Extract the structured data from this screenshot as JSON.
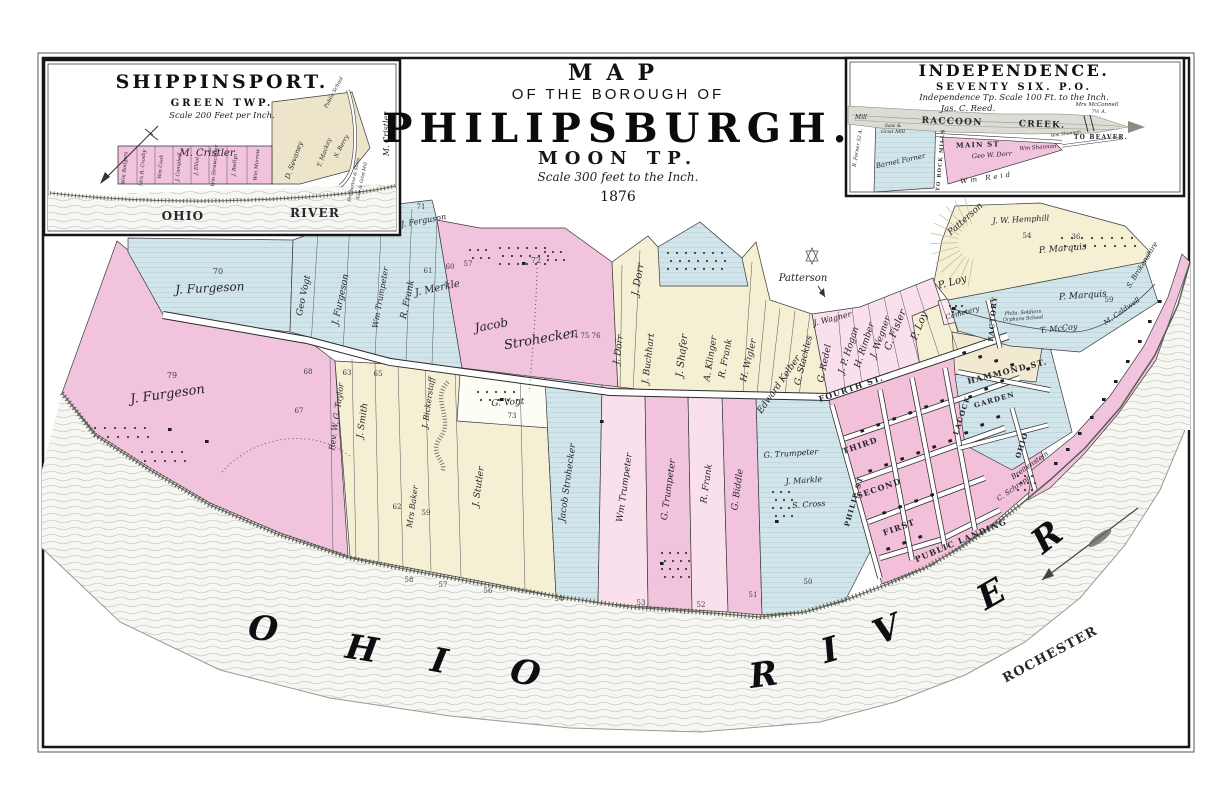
{
  "sheet": {
    "title_small": "MAP",
    "title_sub": "OF THE BOROUGH OF",
    "title_main": "PHILIPSBURGH.",
    "township": "MOON TP.",
    "scale_note": "Scale 300 feet to the Inch.",
    "year": "1876"
  },
  "inset_shippinsport": {
    "title": "SHIPPINSPORT.",
    "subtitle": "GREEN TWP.",
    "scale_note": "Scale 200 Feet per Inch.",
    "labels": [
      {
        "t": "M. Cristler",
        "x": 207,
        "y": 156,
        "s": 10
      },
      {
        "t": "Wm Rodgers",
        "x": 126,
        "y": 168,
        "r": -85,
        "s": 5
      },
      {
        "t": "Mrs R. Crosby",
        "x": 144,
        "y": 168,
        "r": -85,
        "s": 5
      },
      {
        "t": "Wm Cook",
        "x": 162,
        "y": 167,
        "r": -85,
        "s": 5
      },
      {
        "t": "J. Campbell",
        "x": 180,
        "y": 167,
        "r": -85,
        "s": 5
      },
      {
        "t": "J. Elliot",
        "x": 198,
        "y": 166,
        "r": -85,
        "s": 5
      },
      {
        "t": "Wm Strawcutter",
        "x": 216,
        "y": 166,
        "r": -85,
        "s": 5
      },
      {
        "t": "J. Bedlyn",
        "x": 236,
        "y": 165,
        "r": -85,
        "s": 5
      },
      {
        "t": "Wm Morrow",
        "x": 258,
        "y": 165,
        "r": -85,
        "s": 5
      },
      {
        "t": "D. Sevaney",
        "x": 296,
        "y": 161,
        "r": -70,
        "s": 7
      },
      {
        "t": "T. Mackey",
        "x": 326,
        "y": 153,
        "r": -70,
        "s": 6
      },
      {
        "t": "S. Berry",
        "x": 343,
        "y": 147,
        "r": -62,
        "s": 6
      },
      {
        "t": "Public School",
        "x": 335,
        "y": 93,
        "r": -62,
        "s": 5
      },
      {
        "t": "M. Cristler",
        "x": 389,
        "y": 134,
        "r": -90,
        "s": 8
      },
      {
        "t": "Brotherton & Stiles",
        "x": 355,
        "y": 180,
        "r": -78,
        "s": 4.5
      },
      {
        "t": "Saw & Grist Mill",
        "x": 363,
        "y": 181,
        "r": -78,
        "s": 4.5
      },
      {
        "t": "OHIO",
        "x": 183,
        "y": 220,
        "s": 12,
        "ls": 14,
        "c": "st"
      },
      {
        "t": "RIVER",
        "x": 315,
        "y": 217,
        "s": 12,
        "ls": 10,
        "c": "st"
      }
    ]
  },
  "inset_independence": {
    "title": "INDEPENDENCE.",
    "subtitle": "SEVENTY SIX. P.O.",
    "scale_note": "Independence Tp.  Scale 100 Ft. to the Inch.",
    "surveyor": "Jas. C. Reed.",
    "labels": [
      {
        "t": "RACCOON",
        "x": 952,
        "y": 124,
        "r": 2,
        "s": 9,
        "ls": 8,
        "c": "st"
      },
      {
        "t": "CREEK.",
        "x": 1042,
        "y": 127,
        "r": 2,
        "s": 9,
        "ls": 6,
        "c": "st"
      },
      {
        "t": "MAIN   ST",
        "x": 978,
        "y": 147,
        "r": -2,
        "s": 7,
        "ls": 4,
        "c": "st"
      },
      {
        "t": "Mill",
        "x": 861,
        "y": 119,
        "s": 6
      },
      {
        "t": "Saw &",
        "x": 893,
        "y": 127,
        "s": 5
      },
      {
        "t": "Grist Mill",
        "x": 893,
        "y": 133,
        "s": 5
      },
      {
        "t": "Barnet Forner",
        "x": 901,
        "y": 163,
        "r": -12,
        "s": 7
      },
      {
        "t": "Geo W. Dorr",
        "x": 992,
        "y": 157,
        "r": -4,
        "s": 6.5
      },
      {
        "t": "Wm Shannon",
        "x": 1038,
        "y": 149,
        "r": -4,
        "s": 5.5
      },
      {
        "t": "Wm  Reid",
        "x": 987,
        "y": 180,
        "r": -8,
        "s": 7,
        "ls": 3
      },
      {
        "t": "Mrs McConnell",
        "x": 1097,
        "y": 106,
        "s": 5.5
      },
      {
        "t": "7½ A.",
        "x": 1099,
        "y": 113,
        "s": 5
      },
      {
        "t": "TO BEAVER.",
        "x": 1101,
        "y": 139,
        "s": 6,
        "c": "st"
      },
      {
        "t": "Wm Shannon",
        "x": 1066,
        "y": 135,
        "r": -8,
        "s": 4.5
      },
      {
        "t": "TO ROCK MILLS",
        "x": 942,
        "y": 160,
        "r": -85,
        "s": 5,
        "c": "st"
      },
      {
        "t": "B. Forner 52 A.",
        "x": 859,
        "y": 148,
        "r": -80,
        "s": 5
      }
    ]
  },
  "main_map": {
    "labels": [
      {
        "t": "J. Furgeson",
        "x": 210,
        "y": 292,
        "r": -3,
        "s": 12
      },
      {
        "t": "70",
        "x": 218,
        "y": 274,
        "s": 8,
        "c": "num"
      },
      {
        "t": "J. Ferguson",
        "x": 424,
        "y": 223,
        "r": -10,
        "s": 8
      },
      {
        "t": "71",
        "x": 421,
        "y": 209,
        "s": 7,
        "c": "num"
      },
      {
        "t": "J. Furgeson",
        "x": 168,
        "y": 398,
        "r": -8,
        "s": 13
      },
      {
        "t": "79",
        "x": 172,
        "y": 378,
        "s": 8,
        "c": "num"
      },
      {
        "t": "Geo Vogt",
        "x": 306,
        "y": 296,
        "r": -78,
        "s": 9
      },
      {
        "t": "J. Furgeson",
        "x": 343,
        "y": 300,
        "r": -78,
        "s": 9
      },
      {
        "t": "Wm Trumpeter",
        "x": 383,
        "y": 298,
        "r": -80,
        "s": 8
      },
      {
        "t": "R. Frank",
        "x": 410,
        "y": 300,
        "r": -78,
        "s": 9
      },
      {
        "t": "J. Merkle",
        "x": 438,
        "y": 291,
        "r": -12,
        "s": 10
      },
      {
        "t": "61",
        "x": 428,
        "y": 273,
        "s": 7,
        "c": "num"
      },
      {
        "t": "60",
        "x": 450,
        "y": 269,
        "s": 7,
        "c": "num"
      },
      {
        "t": "57",
        "x": 468,
        "y": 266,
        "s": 7,
        "c": "num"
      },
      {
        "t": "Jacob",
        "x": 492,
        "y": 329,
        "r": -10,
        "s": 12
      },
      {
        "t": "Strohecker",
        "x": 541,
        "y": 343,
        "r": -10,
        "s": 13
      },
      {
        "t": "72",
        "x": 536,
        "y": 263,
        "s": 8,
        "c": "num"
      },
      {
        "t": "74 75 76",
        "x": 585,
        "y": 338,
        "s": 7,
        "c": "num"
      },
      {
        "t": "J. Dorr",
        "x": 641,
        "y": 280,
        "r": -80,
        "s": 10
      },
      {
        "t": "J. Dorr",
        "x": 621,
        "y": 350,
        "r": -82,
        "s": 9
      },
      {
        "t": "J. Buchhart",
        "x": 651,
        "y": 359,
        "r": -83,
        "s": 9
      },
      {
        "t": "J. Shafer",
        "x": 685,
        "y": 356,
        "r": -83,
        "s": 10
      },
      {
        "t": "A. Klinger",
        "x": 713,
        "y": 359,
        "r": -81,
        "s": 9
      },
      {
        "t": "R. Frank",
        "x": 728,
        "y": 359,
        "r": -79,
        "s": 9
      },
      {
        "t": "H. Wigler",
        "x": 751,
        "y": 361,
        "r": -76,
        "s": 9
      },
      {
        "t": "Edward Kelber",
        "x": 781,
        "y": 386,
        "r": -55,
        "s": 9
      },
      {
        "t": "G. Stackles",
        "x": 806,
        "y": 361,
        "r": -76,
        "s": 9
      },
      {
        "t": "G. Redel",
        "x": 827,
        "y": 364,
        "r": -78,
        "s": 9
      },
      {
        "t": "J. Wagner",
        "x": 833,
        "y": 321,
        "r": -14,
        "s": 8
      },
      {
        "t": "J. P. Hogan",
        "x": 851,
        "y": 351,
        "r": -72,
        "s": 9
      },
      {
        "t": "H. Rimber",
        "x": 867,
        "y": 346,
        "r": -72,
        "s": 9
      },
      {
        "t": "J. Wegner",
        "x": 883,
        "y": 338,
        "r": -70,
        "s": 9
      },
      {
        "t": "C. Fisler",
        "x": 898,
        "y": 331,
        "r": -68,
        "s": 10
      },
      {
        "t": "P. Loy",
        "x": 922,
        "y": 327,
        "r": -68,
        "s": 10
      },
      {
        "t": "P. Loy",
        "x": 953,
        "y": 285,
        "r": -15,
        "s": 10
      },
      {
        "t": "Cemetery",
        "x": 963,
        "y": 315,
        "r": -15,
        "s": 7
      },
      {
        "t": "Patterson",
        "x": 803,
        "y": 281,
        "s": 10
      },
      {
        "t": "Patterson",
        "x": 967,
        "y": 221,
        "r": -42,
        "s": 9
      },
      {
        "t": "J. W. Hemphill",
        "x": 1021,
        "y": 222,
        "r": -3,
        "s": 8
      },
      {
        "t": "54",
        "x": 1027,
        "y": 238,
        "s": 7,
        "c": "num"
      },
      {
        "t": "P. Marquis",
        "x": 1063,
        "y": 251,
        "r": -5,
        "s": 9
      },
      {
        "t": "36",
        "x": 1076,
        "y": 239,
        "s": 7,
        "c": "num"
      },
      {
        "t": "P. Marquis",
        "x": 1083,
        "y": 298,
        "r": -4,
        "s": 9
      },
      {
        "t": "59",
        "x": 1109,
        "y": 302,
        "s": 7,
        "c": "num"
      },
      {
        "t": "T. McCoy",
        "x": 1059,
        "y": 331,
        "r": -6,
        "s": 8
      },
      {
        "t": "S. Brokenshire",
        "x": 1144,
        "y": 266,
        "r": -58,
        "s": 7
      },
      {
        "t": "M. Caldwell",
        "x": 1123,
        "y": 313,
        "r": -35,
        "s": 7
      },
      {
        "t": "Phila. Soldiers",
        "x": 1023,
        "y": 314,
        "r": -4,
        "s": 5
      },
      {
        "t": "Orphans School",
        "x": 1023,
        "y": 320,
        "r": -4,
        "s": 5
      },
      {
        "t": "Rev. W. G. Taylor",
        "x": 339,
        "y": 417,
        "r": -82,
        "s": 8
      },
      {
        "t": "J. Smith",
        "x": 365,
        "y": 421,
        "r": -82,
        "s": 9
      },
      {
        "t": "J. Bickerstaff",
        "x": 431,
        "y": 403,
        "r": -82,
        "s": 8
      },
      {
        "t": "G. Vogt",
        "x": 508,
        "y": 405,
        "r": -4,
        "s": 9
      },
      {
        "t": "73",
        "x": 512,
        "y": 418,
        "s": 7,
        "c": "num"
      },
      {
        "t": "Mrs Baker",
        "x": 415,
        "y": 507,
        "r": -82,
        "s": 8
      },
      {
        "t": "J. Stutler",
        "x": 481,
        "y": 487,
        "r": -82,
        "s": 9
      },
      {
        "t": "Jacob Strohecker",
        "x": 570,
        "y": 483,
        "r": -82,
        "s": 9
      },
      {
        "t": "Wm Trumpeter",
        "x": 627,
        "y": 488,
        "r": -82,
        "s": 9
      },
      {
        "t": "G. Trumpeter",
        "x": 671,
        "y": 490,
        "r": -82,
        "s": 9
      },
      {
        "t": "R. Frank",
        "x": 709,
        "y": 484,
        "r": -82,
        "s": 9
      },
      {
        "t": "G. Biddle",
        "x": 740,
        "y": 490,
        "r": -82,
        "s": 9
      },
      {
        "t": "G. Trumpeter",
        "x": 791,
        "y": 456,
        "r": -4,
        "s": 8
      },
      {
        "t": "J. Markle",
        "x": 804,
        "y": 483,
        "r": -4,
        "s": 8
      },
      {
        "t": "S. Cross",
        "x": 809,
        "y": 507,
        "r": -4,
        "s": 8
      },
      {
        "t": "68",
        "x": 308,
        "y": 374,
        "s": 7,
        "c": "num"
      },
      {
        "t": "67",
        "x": 299,
        "y": 413,
        "s": 7,
        "c": "num"
      },
      {
        "t": "63",
        "x": 347,
        "y": 375,
        "s": 7,
        "c": "num"
      },
      {
        "t": "65",
        "x": 378,
        "y": 376,
        "s": 7,
        "c": "num"
      },
      {
        "t": "62",
        "x": 397,
        "y": 509,
        "s": 7,
        "c": "num"
      },
      {
        "t": "59",
        "x": 426,
        "y": 515,
        "s": 7,
        "c": "num"
      },
      {
        "t": "58",
        "x": 409,
        "y": 582,
        "s": 7,
        "c": "num"
      },
      {
        "t": "57",
        "x": 443,
        "y": 587,
        "s": 7,
        "c": "num"
      },
      {
        "t": "56",
        "x": 488,
        "y": 593,
        "s": 7,
        "c": "num"
      },
      {
        "t": "54",
        "x": 559,
        "y": 601,
        "s": 7,
        "c": "num"
      },
      {
        "t": "53",
        "x": 641,
        "y": 605,
        "s": 7,
        "c": "num"
      },
      {
        "t": "52",
        "x": 701,
        "y": 607,
        "s": 7,
        "c": "num"
      },
      {
        "t": "51",
        "x": 753,
        "y": 597,
        "s": 7,
        "c": "num"
      },
      {
        "t": "50",
        "x": 808,
        "y": 584,
        "s": 7,
        "c": "num"
      },
      {
        "t": "FOURTH ST.",
        "x": 852,
        "y": 391,
        "r": -19,
        "s": 8,
        "c": "st"
      },
      {
        "t": "THIRD",
        "x": 861,
        "y": 448,
        "r": -19,
        "s": 8,
        "c": "st"
      },
      {
        "t": "SECOND",
        "x": 880,
        "y": 491,
        "r": -19,
        "s": 8,
        "c": "st"
      },
      {
        "t": "FIRST",
        "x": 900,
        "y": 530,
        "r": -20,
        "s": 8,
        "c": "st"
      },
      {
        "t": "PUBLIC  LANDING",
        "x": 962,
        "y": 543,
        "r": -23,
        "s": 8,
        "ls": 2,
        "c": "st"
      },
      {
        "t": "PHILIP ST",
        "x": 856,
        "y": 502,
        "r": -74,
        "s": 7,
        "c": "st"
      },
      {
        "t": "HAMMOND ST.",
        "x": 1008,
        "y": 374,
        "r": -14,
        "s": 8,
        "c": "st"
      },
      {
        "t": "GARDEN",
        "x": 995,
        "y": 402,
        "r": -16,
        "s": 7,
        "c": "st"
      },
      {
        "t": "LACOCK",
        "x": 964,
        "y": 416,
        "r": -72,
        "s": 7,
        "c": "st"
      },
      {
        "t": "OHIO",
        "x": 1024,
        "y": 446,
        "r": -72,
        "s": 7,
        "c": "st"
      },
      {
        "t": "FACTORY",
        "x": 995,
        "y": 319,
        "r": -85,
        "s": 7,
        "c": "st"
      },
      {
        "t": "Breitenstein",
        "x": 1031,
        "y": 467,
        "r": -35,
        "s": 7
      },
      {
        "t": "C. Schropp",
        "x": 1015,
        "y": 490,
        "r": -35,
        "s": 7
      }
    ]
  },
  "river": {
    "texts": [
      {
        "t": "O",
        "x": 262,
        "y": 640,
        "r": 6,
        "s": 34,
        "c": "rl"
      },
      {
        "t": "H",
        "x": 360,
        "y": 660,
        "r": 9,
        "s": 34,
        "c": "rl"
      },
      {
        "t": "I",
        "x": 437,
        "y": 672,
        "r": 11,
        "s": 34,
        "c": "rl"
      },
      {
        "t": "O",
        "x": 523,
        "y": 684,
        "r": 12,
        "s": 34,
        "c": "rl"
      },
      {
        "t": "R",
        "x": 765,
        "y": 686,
        "r": -8,
        "s": 34,
        "c": "rl"
      },
      {
        "t": "I",
        "x": 833,
        "y": 661,
        "r": -16,
        "s": 34,
        "c": "rl"
      },
      {
        "t": "V",
        "x": 891,
        "y": 640,
        "r": -22,
        "s": 34,
        "c": "rl"
      },
      {
        "t": "E",
        "x": 997,
        "y": 604,
        "r": -30,
        "s": 34,
        "c": "rl"
      },
      {
        "t": "R",
        "x": 1054,
        "y": 546,
        "r": -38,
        "s": 34,
        "c": "rl"
      },
      {
        "t": "ROCHESTER",
        "x": 1052,
        "y": 658,
        "r": -28,
        "s": 13,
        "ls": 5,
        "c": "st"
      }
    ]
  }
}
